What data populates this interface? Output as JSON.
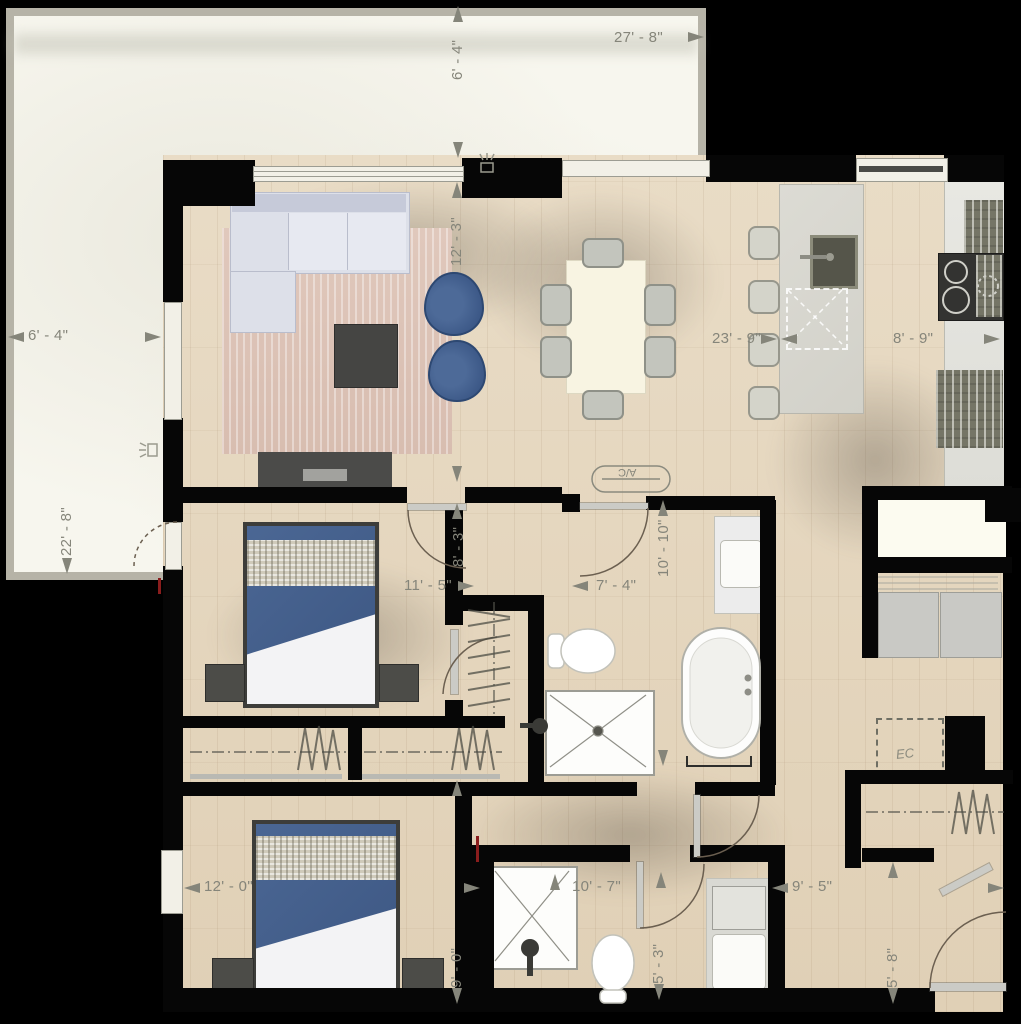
{
  "dims": {
    "terrace_width": "27' - 8\"",
    "terrace_top_depth": "6' - 4\"",
    "terrace_left_depth": "6' - 4\"",
    "terrace_height": "22' - 8\"",
    "living_depth": "12' - 3\"",
    "great_room_width": "23' - 9\"",
    "kitchen_width": "8' - 9\"",
    "bedroom1_width": "11' - 5\"",
    "bedroom1_door_offset": "8' - 3\"",
    "hall_width": "7' - 4\"",
    "bath1_depth": "10' - 10\"",
    "hall2_width": "9' - 5\"",
    "entry_depth": "5' - 8\"",
    "bedroom2_width": "12' - 0\"",
    "bedroom2_depth": "9' - 0\"",
    "bath2_width": "10' - 7\"",
    "wc_depth": "5' - 3\""
  },
  "labels": {
    "ac_unit": "A/C",
    "electrical_closet": "EC"
  },
  "colors": {
    "wall": "#060606",
    "wood_floor": "#e5d6bf",
    "terrace": "#f7f6ee",
    "dimension_text": "#85857a",
    "accent_blue": "#3d5a88",
    "rug": "#dcc4b7"
  }
}
